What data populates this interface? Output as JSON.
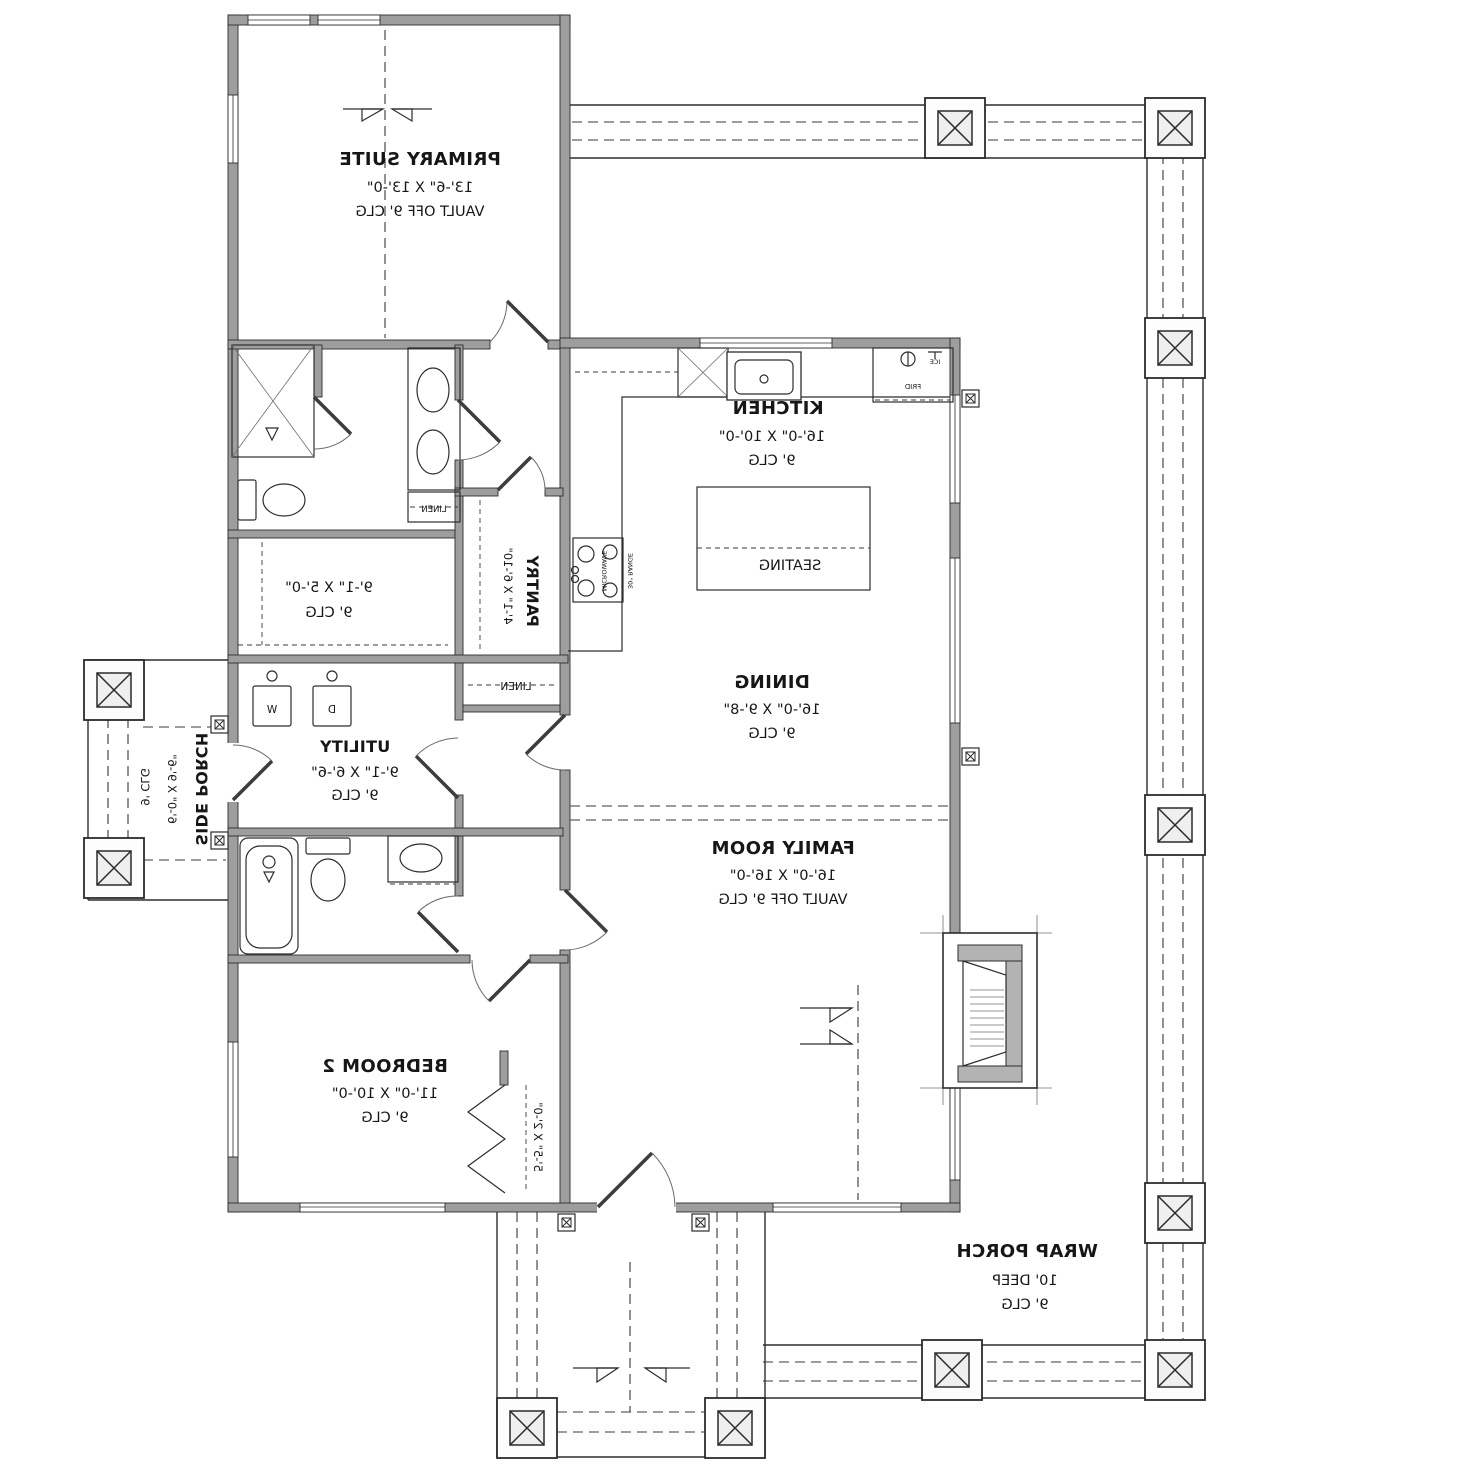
{
  "floor_plan": {
    "rooms": {
      "primary_suite": {
        "name": "PRIMARY SUITE",
        "dims": "13'-6\" X 13'-0\"",
        "ceiling": "VAULT OFF 9' CLG"
      },
      "kitchen": {
        "name": "KITCHEN",
        "dims": "16'-0\" X 10'-0\"",
        "ceiling": "9' CLG"
      },
      "dining": {
        "name": "DINING",
        "dims": "16'-0\" X 9'-8\"",
        "ceiling": "9' CLG"
      },
      "family_room": {
        "name": "FAMILY ROOM",
        "dims": "16'-0\" X 16'-0\"",
        "ceiling": "VAULT OFF 9' CLG"
      },
      "bedroom_2": {
        "name": "BEDROOM 2",
        "dims": "11'-0\" X 10'-0\"",
        "ceiling": "9' CLG"
      },
      "utility": {
        "name": "UTILITY",
        "dims": "9'-1\" X 6'-6\"",
        "ceiling": "9' CLG"
      },
      "walk_in_closet": {
        "dims": "9'-1\" X 5'-0\"",
        "ceiling": "9' CLG"
      },
      "pantry": {
        "name": "PANTRY",
        "dims": "4'-1\" X 6'-10\""
      },
      "bedroom_2_closet": {
        "dims": "5'-5\" X 2'-0\""
      },
      "side_porch": {
        "name": "SIDE PORCH",
        "dims": "6'-0\" X 9'-6\"",
        "ceiling": "9' CLG"
      },
      "wrap_porch": {
        "name": "WRAP PORCH",
        "dims": "10' DEEP",
        "ceiling": "9' CLG"
      }
    },
    "fixtures": {
      "seating": "SEATING",
      "linen_bath": "LINEN",
      "linen_hall": "LINEN",
      "washer": "W",
      "dryer": "D",
      "fridge": "FRID",
      "ice_maker": "ICE",
      "microwave": "MICROWAVE",
      "range": "30\" RANGE"
    },
    "style": {
      "wall_fill": "#9e9e9e",
      "line_color": "#2d2d2d",
      "background": "#ffffff"
    }
  }
}
